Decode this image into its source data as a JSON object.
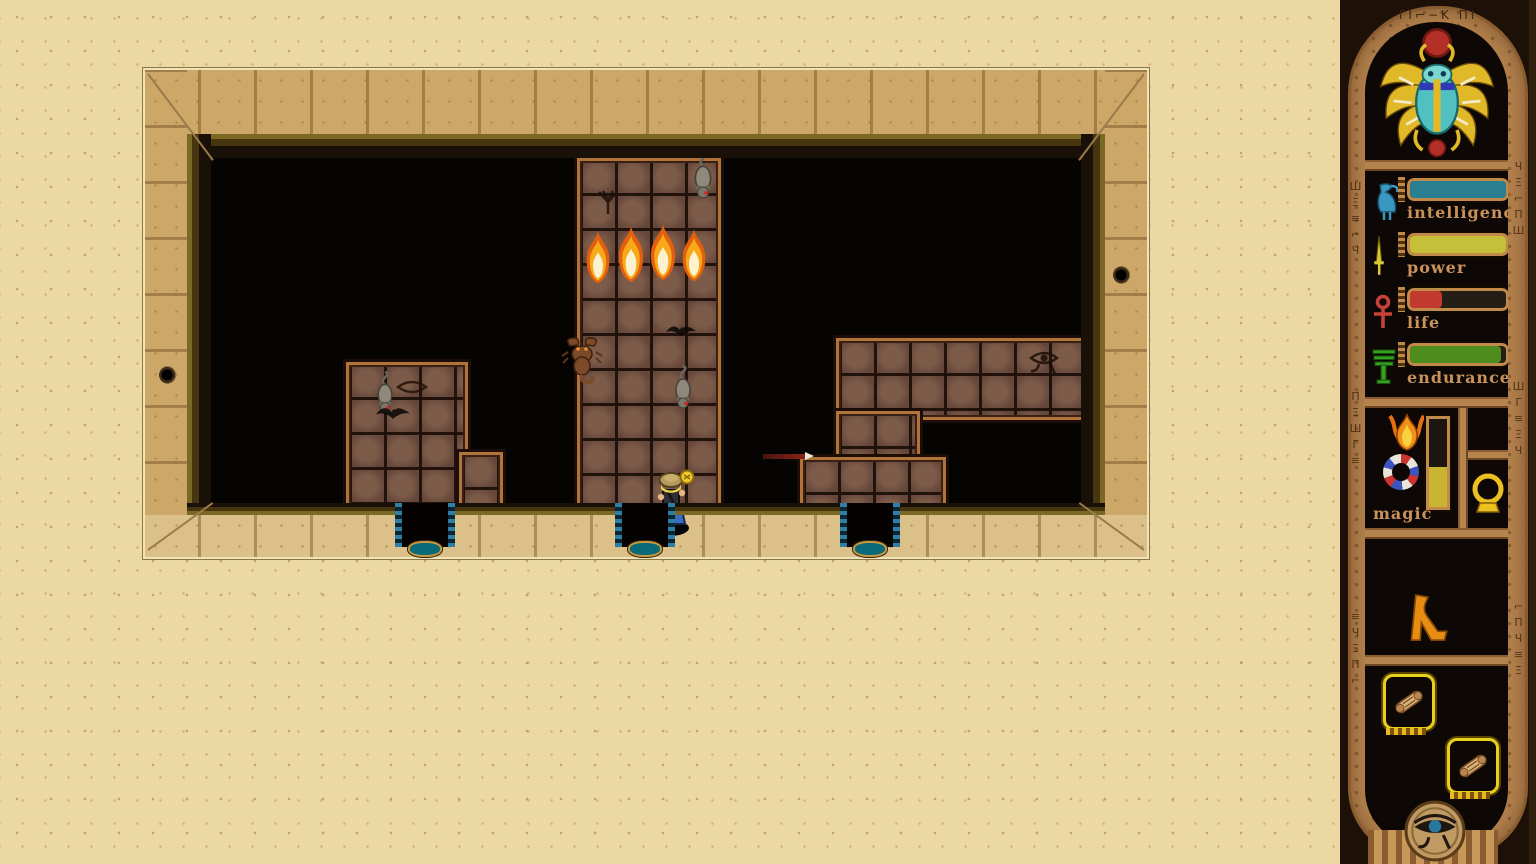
{
  "hud": {
    "top_glyphs": "ΓI⌐−K ΠI",
    "rail_glyphs": {
      "left_upper": "ШΞ≡⌐Ч",
      "left_mid": "ΠΞШΓ≡",
      "left_lower": "≡ЧΞΠ⌐",
      "right_upper": "ЧΞ⌐ΠШ",
      "right_mid": "ШΓ≡ΞЧ",
      "right_lower": "⌐ΠЧ≡Ξ"
    },
    "emblem_icon": "scarab-beetle",
    "stats": [
      {
        "label": "intelligence",
        "icon": "ibis-bird-icon",
        "bar_color": "#2a8090",
        "fill_pct": 100
      },
      {
        "label": "power",
        "icon": "sword-icon",
        "bar_color": "#c6bf39",
        "fill_pct": 100
      },
      {
        "label": "life",
        "icon": "ankh-icon",
        "bar_color": "#c23a2e",
        "fill_pct": 33
      },
      {
        "label": "endurance",
        "icon": "reed-plant-icon",
        "bar_color": "#4f8c1e",
        "fill_pct": 95
      }
    ],
    "magic": {
      "label": "magic",
      "gauge_color": "#c9b431",
      "fill_pct": 46,
      "icons": [
        "phoenix-flame-icon",
        "striped-ring-icon"
      ]
    },
    "equipment": {
      "mirror_icon": "mirror-amulet-icon",
      "legs_icon": "walking-legs-icon",
      "scroll_slots": 2
    },
    "bottom_icon": "eye-of-horus-medallion"
  },
  "room": {
    "entities": {
      "fires": 4,
      "rats": 3,
      "scorpions": 1,
      "bats": 2,
      "player": "explorer-with-lamp",
      "projectile": "dart"
    },
    "doors": 3,
    "wall_holes": 2
  }
}
